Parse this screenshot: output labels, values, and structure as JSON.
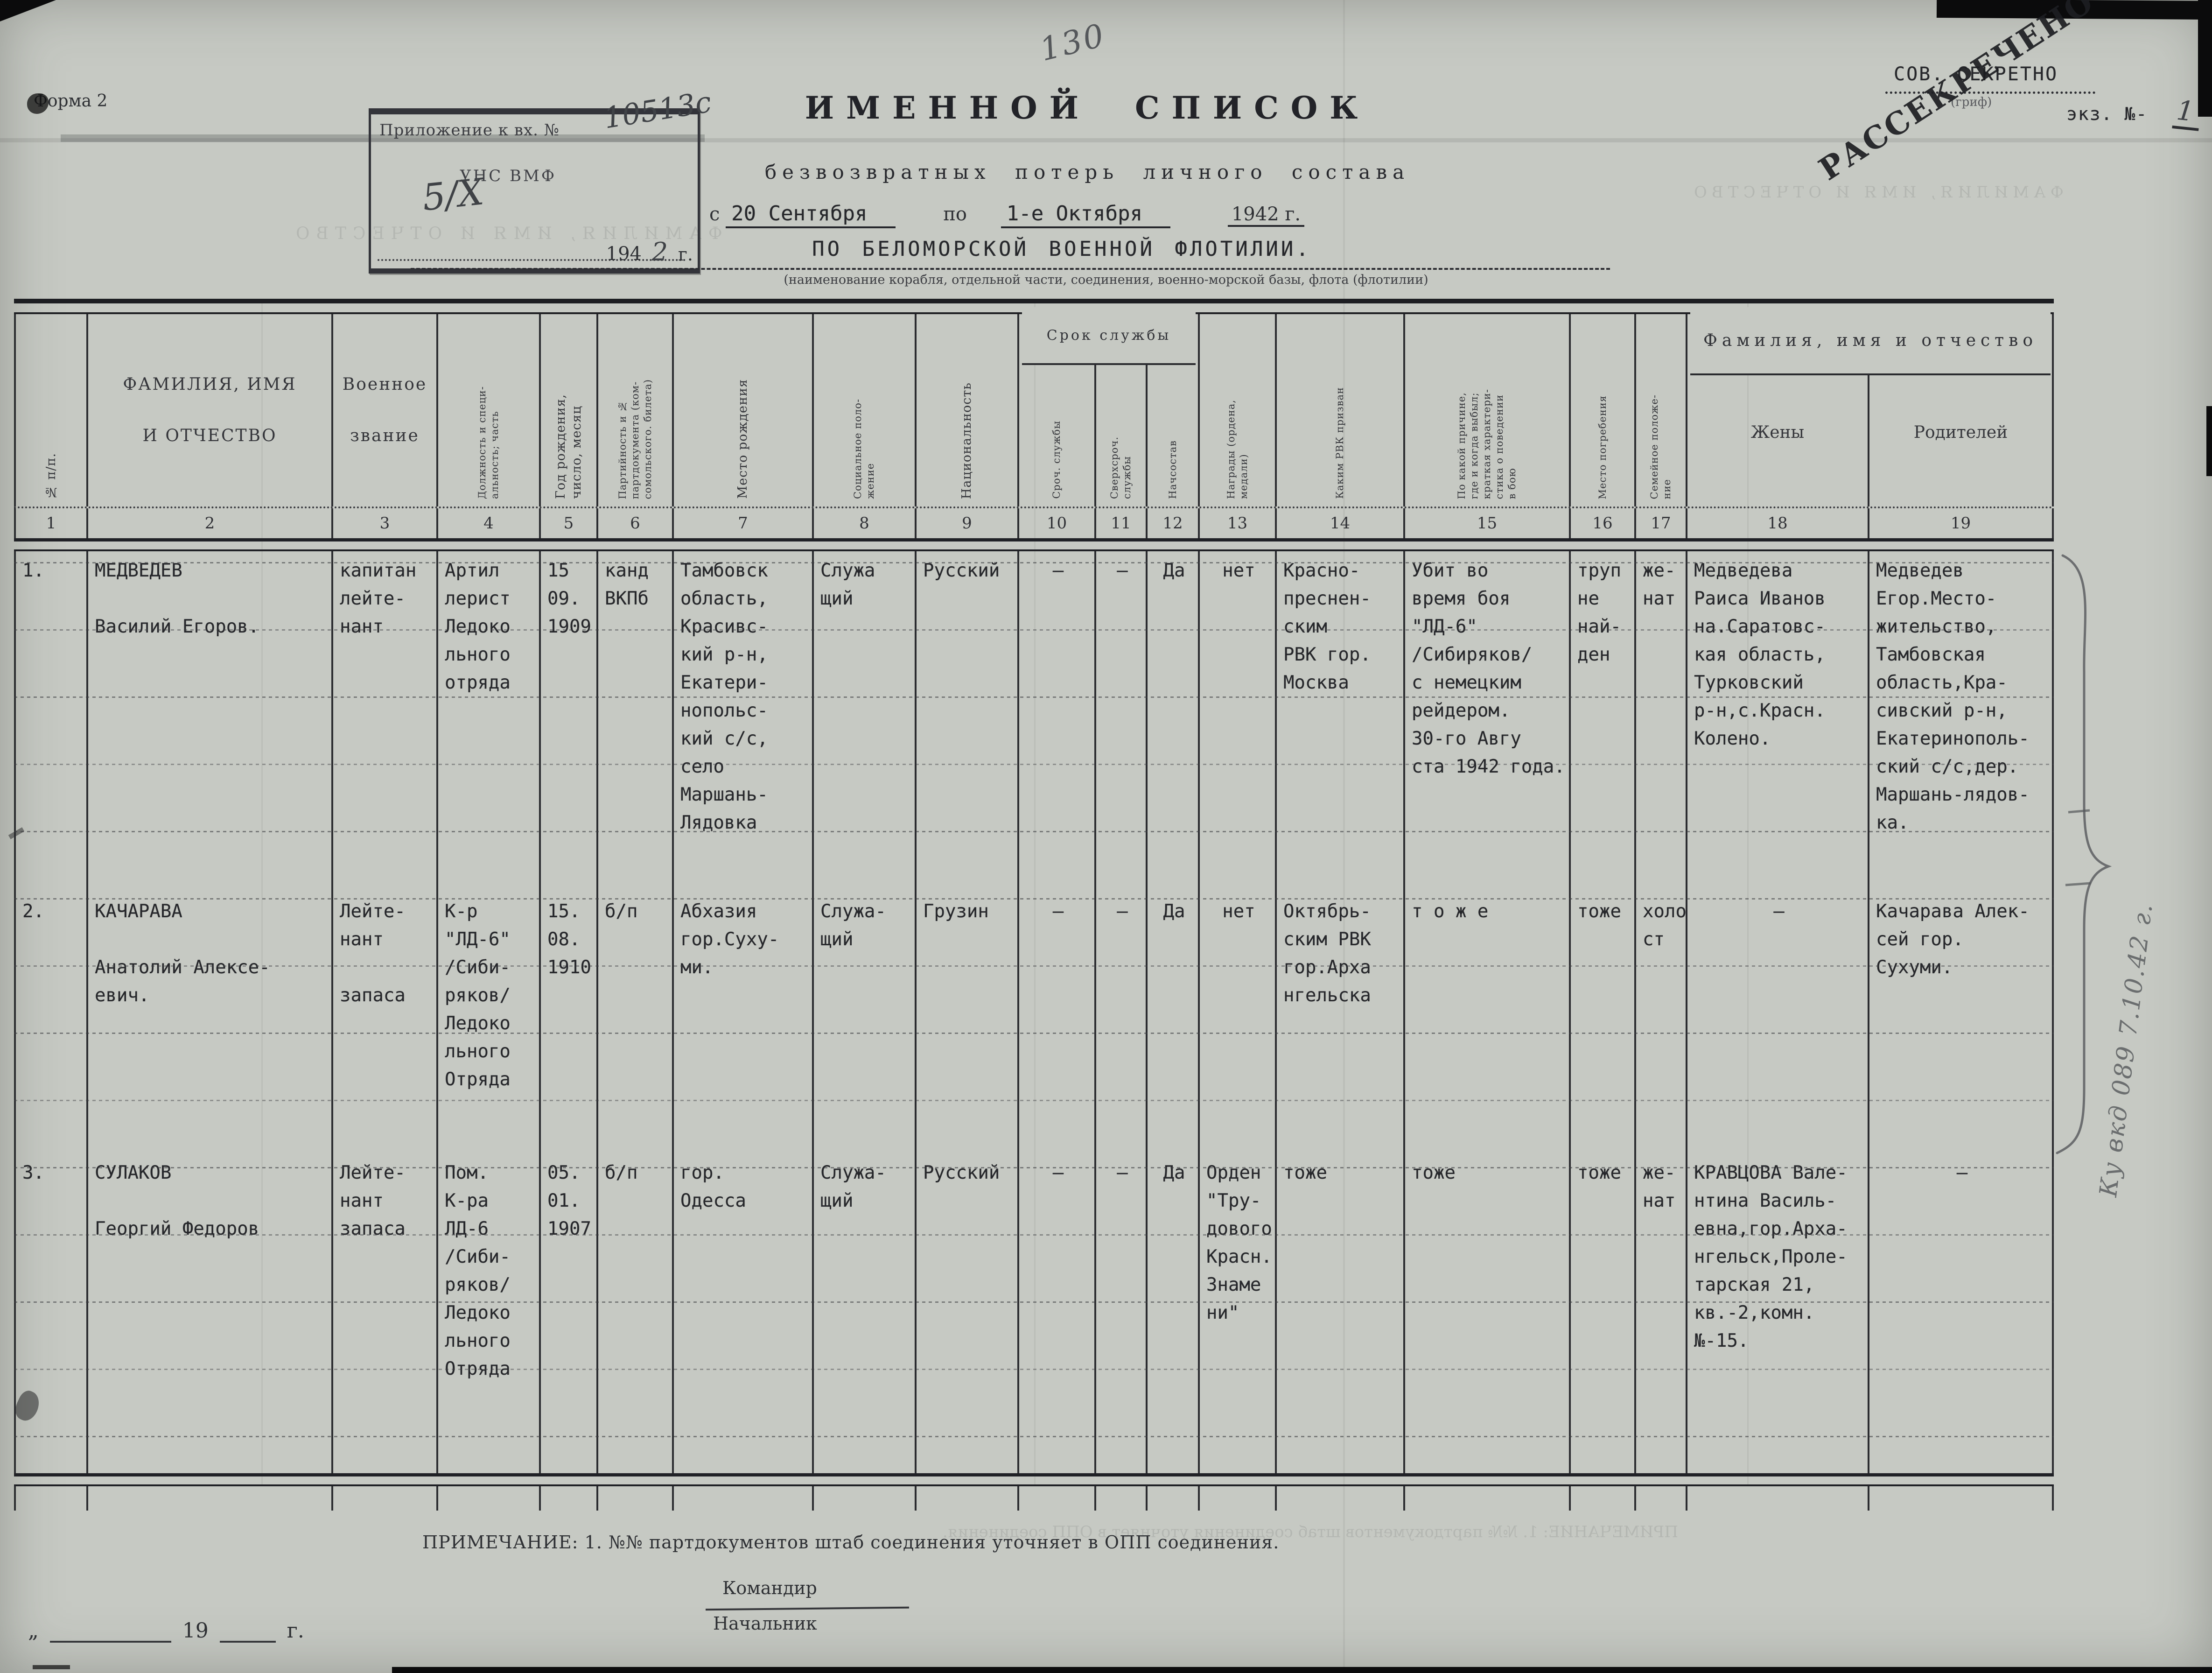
{
  "page": {
    "form_label": "Форма 2",
    "page_number_pencil": "130"
  },
  "stamp_box": {
    "line1": "Приложение к вх. №",
    "number_hand": "10513с",
    "line2": "УНС ВМФ",
    "date_hand": "5/X",
    "year_printed": "194",
    "year_hand": "2",
    "year_suffix": "г."
  },
  "classification": {
    "secret": "СОВ. СЕКРЕТНО",
    "secret_caption": "(гриф)",
    "declass_stamp": "РАССЕКРЕЧЕНО",
    "copy_label": "экз. №-",
    "copy_number_hand": "1"
  },
  "title": {
    "main": "ИМЕННОЙ СПИСОК",
    "sub": "безвозвратных потерь личного состава",
    "period_prefix": "с",
    "period_from": "20 Сентября",
    "period_mid": "по",
    "period_to": "1-е Октября",
    "period_year": "1942 г.",
    "unit": "ПО БЕЛОМОРСКОЙ ВОЕННОЙ ФЛОТИЛИИ.",
    "unit_caption": "(наименование корабля, отдельной части, соединения, военно-морской базы, флота (флотилии)"
  },
  "table": {
    "group_headers": {
      "service_term": "Срок службы",
      "family": "Фамилия, имя и отчество"
    },
    "columns": [
      {
        "num": "1",
        "label": "№ п/п."
      },
      {
        "num": "2",
        "label": "ФАМИЛИЯ, ИМЯ\nИ ОТЧЕСТВО"
      },
      {
        "num": "3",
        "label": "Военное\nзвание"
      },
      {
        "num": "4",
        "label": "Должность и специ-\nальность; часть"
      },
      {
        "num": "5",
        "label": "Год рождения,\nчисло, месяц"
      },
      {
        "num": "6",
        "label": "Партийность и №\nпартдокумента (ком-\nсомольского. билета)"
      },
      {
        "num": "7",
        "label": "Место рождения"
      },
      {
        "num": "8",
        "label": "Социальное поло-\nжение"
      },
      {
        "num": "9",
        "label": "Национальность"
      },
      {
        "num": "10",
        "label": "Сроч. службы"
      },
      {
        "num": "11",
        "label": "Сверхсроч.\nслужбы"
      },
      {
        "num": "12",
        "label": "Начсостав"
      },
      {
        "num": "13",
        "label": "Награды (ордена,\nмедали)"
      },
      {
        "num": "14",
        "label": "Каким РВК призван"
      },
      {
        "num": "15",
        "label": "По какой причине,\nгде и когда выбыл;\nкраткая характери-\nстика о поведении\nв бою"
      },
      {
        "num": "16",
        "label": "Место погребения"
      },
      {
        "num": "17",
        "label": "Семейное положе-\nние"
      },
      {
        "num": "18",
        "label": "Жены"
      },
      {
        "num": "19",
        "label": "Родителей"
      }
    ],
    "rows": [
      {
        "cells": [
          "1.",
          "МЕДВЕДЕВ\n\nВасилий Егоров.",
          "капитан\nлейте-\nнант",
          "Артил\nлерист\nЛедоко\nльного\nотряда",
          "15\n09.\n1909",
          "канд\nВКПб",
          "Тамбовск\nобласть,\nКрасивс-\nкий р-н,\nЕкатери-\nнопольс-\nкий с/с,\nсело\nМаршань-\nЛядовка",
          "Служа\nщий",
          "Русский",
          "–",
          "–",
          "Да",
          "нет",
          "Красно-\nпреснен-\nским\nРВК гор.\nМосква",
          "Убит во\nвремя боя\n\"ЛД-6\"\n/Сибиряков/\nс немецким\nрейдером.\n30-го Авгу\nста 1942 года.",
          "труп\nне\nнай-\nден",
          "же-\nнат",
          "Медведева\nРаиса Иванов\nна.Саратовс-\nкая область,\nТурковский\nр-н,с.Красн.\nКолено.",
          "Медведев\nЕгор.Место-\nжительство,\nТамбовская\nобласть,Кра-\nсивский р-н,\nЕкатеринополь-\nский с/с,дер.\nМаршань-лядов-\nка."
        ]
      },
      {
        "cells": [
          "2.",
          "КАЧАРАВА\n\nАнатолий Алексе-\nевич.",
          "Лейте-\nнант\n\nзапаса",
          "К-р\n\"ЛД-6\"\n/Сиби-\nряков/\nЛедоко\nльного\nОтряда",
          "15.\n08.\n1910",
          "б/п",
          "Абхазия\nгор.Суху-\nми.",
          "Служа-\nщий",
          "Грузин",
          "–",
          "–",
          "Да",
          "нет",
          "Октябрь-\nским РВК\nгор.Арха\nнгельска",
          "т о ж е",
          "тоже",
          "холо\nст",
          "–",
          "Качарава Алек-\nсей гор.\nСухуми."
        ]
      },
      {
        "cells": [
          "3.",
          "СУЛАКОВ\n\nГеоргий Федоров",
          "Лейте-\nнант\nзапаса",
          "Пом.\nК-ра\nЛД-6\n/Сиби-\nряков/\nЛедоко\nльного\nОтряда",
          "05.\n01.\n1907",
          "б/п",
          "гор.\nОдесса",
          "Служа-\nщий",
          "Русский",
          "–",
          "–",
          "Да",
          "Орден\n\"Тру-\nдового\nКрасн.\nЗнаме\nни\"",
          "тоже",
          "тоже",
          "тоже",
          "же-\nнат",
          "КРАВЦОВА Вале-\nнтина Василь-\nевна,гор.Арха-\nнгельск,Проле-\nтарская 21,\nкв.-2,комн.\n№-15.",
          "—"
        ]
      }
    ]
  },
  "margin_notes": {
    "right_pencil": "Ку вкд 089  7.10.42 г."
  },
  "footer": {
    "note": "ПРИМЕЧАНИЕ: 1. №№ партдокументов штаб соединения уточняет в ОПП соединения.",
    "commander_label": "Командир",
    "chief_label": "Начальник",
    "open_quote": "„",
    "year_blank": "19",
    "year_suffix": "г."
  },
  "bleedthrough": {
    "top_text": "ФАМИЛИЯ, ИМЯ И ОТЧЕСТВО",
    "bottom_text": "ПРИМЕЧАНИЕ: 1. №№ партдокументов штаб соединения уточняет в ОПП соединения."
  }
}
